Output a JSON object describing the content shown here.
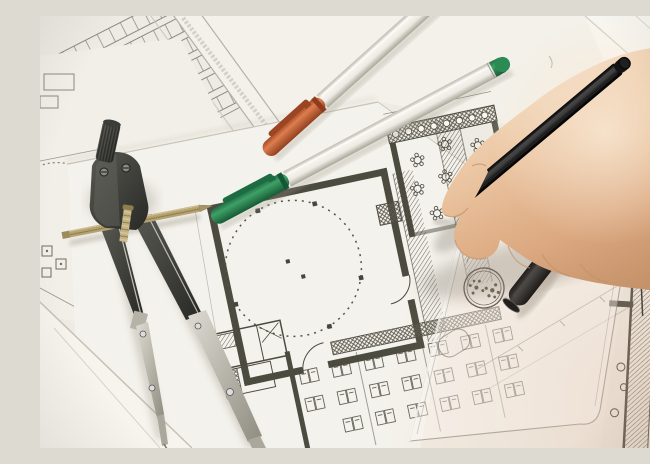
{
  "scene": {
    "description": "Close-up photograph of an architect's workspace: a hand holding a black pen writes over architectural floor-plan blueprints; a steel drafting compass, two white felt-tip pens with orange and green caps, a black pen cap and a transparent set-square ruler with a circular seal stamp lie on the overlapping drawing sheets.",
    "objects": [
      {
        "name": "floor-plan-sheets",
        "note": "overlapping white blueprint sheets with plan linework"
      },
      {
        "name": "drafting-compass",
        "note": "dark steel bow compass with brass adjustment screw"
      },
      {
        "name": "orange-cap-pen",
        "note": "white felt pen, orange cap"
      },
      {
        "name": "green-cap-pen",
        "note": "white felt pen, green cap and green tail plug"
      },
      {
        "name": "black-pen",
        "note": "black pen held in right hand, tip touching drawing"
      },
      {
        "name": "black-pen-cap",
        "note": "black cap with silver ring lying on set square"
      },
      {
        "name": "set-square",
        "note": "transparent triangle ruler with rounded corner, cutout and printed seal"
      },
      {
        "name": "hand",
        "note": "right hand entering from the right edge"
      }
    ]
  },
  "palette": {
    "paper": "#eeebe4",
    "paper-bright": "#f8f6f1",
    "paper-mid": "#f4f2ec",
    "paper-warm": "#efe6da",
    "ink": "#4c4b40",
    "ink-light": "#8d897b",
    "edge": "#c8c3b6",
    "compass-dark": "#3a3a36",
    "metal-silver": "#c9c6bc",
    "brass": "#b5a372",
    "pen-green": "#2c8a54",
    "pen-green-dark": "#1d6b42",
    "pen-orange": "#c25a2c",
    "pen-orange-dark": "#9c4522",
    "pen-black": "#121212",
    "skin": "#e3b392",
    "skin-light": "#f3dcc3",
    "skin-shadow": "#bd8a5f"
  }
}
